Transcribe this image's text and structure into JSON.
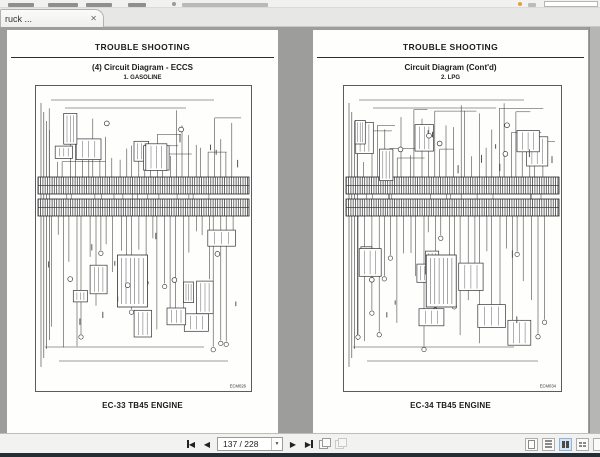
{
  "tab": {
    "label": "ruck ...",
    "close_glyph": "✕"
  },
  "nav": {
    "page_indicator": "137 / 228",
    "first_label": "first-page",
    "prev_glyph": "◀",
    "next_glyph": "▶",
    "caret_glyph": "▼"
  },
  "pages": [
    {
      "header": "TROUBLE SHOOTING",
      "title": "(4) Circuit Diagram - ECCS",
      "subtitle": "1. GASOLINE",
      "footer": "EC-33 TB45 ENGINE",
      "code": "ECM026"
    },
    {
      "header": "TROUBLE SHOOTING",
      "title": "Circuit Diagram (Cont'd)",
      "subtitle": "2. LPG",
      "footer": "EC-34 TB45 ENGINE",
      "code": "ECM034"
    }
  ],
  "colors": {
    "doc_bg": "#9d9d9b",
    "toolbar_bg": "#f2f2f0",
    "selected_layout": "#d7e6f5",
    "tip_dot_orange": "#e2a23c"
  }
}
